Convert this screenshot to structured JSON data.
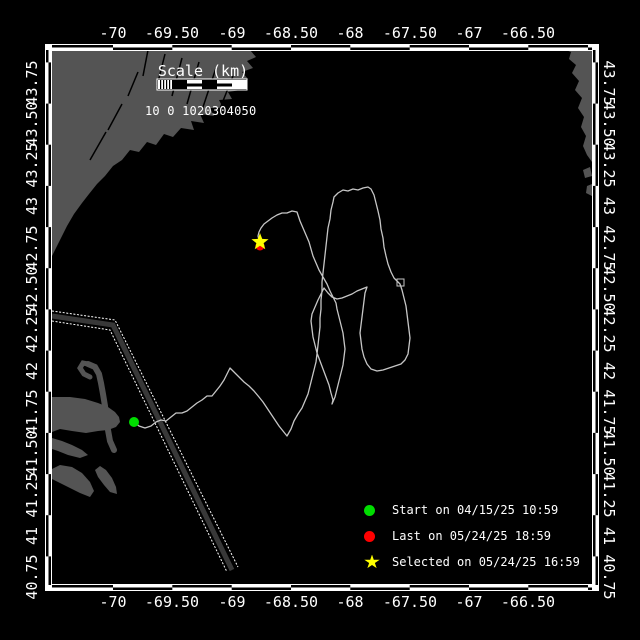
{
  "colors": {
    "background": "#000000",
    "land": "#545454",
    "track": "#c6c6c6",
    "frame": "#ffffff",
    "lane": "#383838",
    "start_green": "#00dd00",
    "last_red": "#ff0000",
    "selected_yellow": "#ffff00"
  },
  "scale_bar": {
    "title": "Scale (km)",
    "numbers": "10 0 1020304050"
  },
  "legend": {
    "items": [
      {
        "marker": "dot",
        "color": "#00dd00",
        "label": "Start on 04/15/25 10:59"
      },
      {
        "marker": "dot",
        "color": "#ff0000",
        "label": "Last on 05/24/25 18:59"
      },
      {
        "marker": "star",
        "color": "#ffff00",
        "label": "Selected on 05/24/25 16:59"
      }
    ],
    "row_tops": [
      501,
      527,
      553
    ]
  },
  "axes": {
    "top": [
      {
        "t": "-70",
        "x": 113
      },
      {
        "t": "-69.50",
        "x": 172
      },
      {
        "t": "-69",
        "x": 232
      },
      {
        "t": "-68.50",
        "x": 291
      },
      {
        "t": "-68",
        "x": 350
      },
      {
        "t": "-67.50",
        "x": 410
      },
      {
        "t": "-67",
        "x": 469
      },
      {
        "t": "-66.50",
        "x": 528
      }
    ],
    "bottom": [
      {
        "t": "-70",
        "x": 113
      },
      {
        "t": "-69.50",
        "x": 172
      },
      {
        "t": "-69",
        "x": 232
      },
      {
        "t": "-68.50",
        "x": 291
      },
      {
        "t": "-68",
        "x": 350
      },
      {
        "t": "-67.50",
        "x": 410
      },
      {
        "t": "-67",
        "x": 469
      },
      {
        "t": "-66.50",
        "x": 528
      }
    ],
    "left": [
      {
        "t": "43.75",
        "y": 83
      },
      {
        "t": "43.50",
        "y": 124
      },
      {
        "t": "43.25",
        "y": 165
      },
      {
        "t": "43",
        "y": 206
      },
      {
        "t": "42.75",
        "y": 248
      },
      {
        "t": "42.50",
        "y": 289
      },
      {
        "t": "42.25",
        "y": 330
      },
      {
        "t": "42",
        "y": 371
      },
      {
        "t": "41.75",
        "y": 412
      },
      {
        "t": "41.50",
        "y": 453
      },
      {
        "t": "41.25",
        "y": 495
      },
      {
        "t": "41",
        "y": 536
      },
      {
        "t": "40.75",
        "y": 577
      }
    ],
    "right": [
      {
        "t": "43.75",
        "y": 83
      },
      {
        "t": "43.50",
        "y": 124
      },
      {
        "t": "43.25",
        "y": 165
      },
      {
        "t": "43",
        "y": 206
      },
      {
        "t": "42.75",
        "y": 248
      },
      {
        "t": "42.50",
        "y": 289
      },
      {
        "t": "42.25",
        "y": 330
      },
      {
        "t": "42",
        "y": 371
      },
      {
        "t": "41.75",
        "y": 412
      },
      {
        "t": "41.50",
        "y": 453
      },
      {
        "t": "41.25",
        "y": 495
      },
      {
        "t": "41",
        "y": 536
      },
      {
        "t": "40.75",
        "y": 577
      }
    ]
  },
  "frame": {
    "x0": 52,
    "x1": 592,
    "y0": 50,
    "y1": 585,
    "lon_bounds": [
      52,
      113,
      172.3,
      231.7,
      291,
      350.3,
      409.7,
      469,
      528.3,
      588,
      592
    ],
    "lat_bounds": [
      50,
      62.4,
      103.6,
      144.7,
      185.9,
      227.1,
      268.2,
      309.4,
      350.6,
      391.7,
      432.9,
      474.1,
      515.2,
      556.4,
      585
    ]
  },
  "markers": {
    "start": {
      "x": 134,
      "y": 422,
      "r": 5
    },
    "last": {
      "x": 260,
      "y": 246,
      "r": 4.5
    },
    "selected": {
      "x": 260,
      "y": 242,
      "scale": 1.0
    }
  },
  "legend_marker_star_scale": 0.85,
  "shapes": {
    "land": [
      {
        "name": "land-maine",
        "points": [
          [
            52,
            50
          ],
          [
            250,
            50
          ],
          [
            256,
            57
          ],
          [
            247,
            61
          ],
          [
            253,
            68
          ],
          [
            242,
            72
          ],
          [
            248,
            79
          ],
          [
            236,
            83
          ],
          [
            241,
            90
          ],
          [
            228,
            92
          ],
          [
            232,
            99
          ],
          [
            219,
            100
          ],
          [
            223,
            108
          ],
          [
            210,
            108
          ],
          [
            214,
            116
          ],
          [
            200,
            114
          ],
          [
            204,
            123
          ],
          [
            191,
            121
          ],
          [
            194,
            130
          ],
          [
            181,
            128
          ],
          [
            173,
            137
          ],
          [
            164,
            134
          ],
          [
            156,
            145
          ],
          [
            147,
            142
          ],
          [
            139,
            152
          ],
          [
            130,
            150
          ],
          [
            122,
            160
          ],
          [
            113,
            166
          ],
          [
            105,
            176
          ],
          [
            97,
            184
          ],
          [
            89,
            194
          ],
          [
            82,
            203
          ],
          [
            74,
            214
          ],
          [
            67,
            226
          ],
          [
            61,
            238
          ],
          [
            56,
            248
          ],
          [
            52,
            256
          ]
        ]
      },
      {
        "name": "land-nova-scotia",
        "points": [
          [
            566,
            50
          ],
          [
            592,
            50
          ],
          [
            592,
            162
          ],
          [
            587,
            155
          ],
          [
            583,
            146
          ],
          [
            586,
            136
          ],
          [
            581,
            127
          ],
          [
            584,
            117
          ],
          [
            578,
            108
          ],
          [
            582,
            98
          ],
          [
            575,
            90
          ],
          [
            579,
            81
          ],
          [
            572,
            73
          ],
          [
            576,
            65
          ],
          [
            569,
            59
          ],
          [
            571,
            52
          ]
        ]
      },
      {
        "name": "land-islet-1",
        "points": [
          [
            583,
            170
          ],
          [
            590,
            167
          ],
          [
            592,
            176
          ],
          [
            585,
            178
          ]
        ]
      },
      {
        "name": "land-islet-2",
        "points": [
          [
            587,
            186
          ],
          [
            592,
            184
          ],
          [
            592,
            196
          ],
          [
            586,
            193
          ]
        ]
      },
      {
        "name": "land-cape-mainland",
        "points": [
          [
            52,
            397
          ],
          [
            70,
            397
          ],
          [
            85,
            399
          ],
          [
            98,
            403
          ],
          [
            108,
            407
          ],
          [
            115,
            412
          ],
          [
            119,
            417
          ],
          [
            120,
            422
          ],
          [
            116,
            427
          ],
          [
            108,
            430
          ],
          [
            98,
            431
          ],
          [
            86,
            433
          ],
          [
            72,
            431
          ],
          [
            60,
            429
          ],
          [
            52,
            432
          ]
        ]
      },
      {
        "name": "land-cape-south",
        "points": [
          [
            52,
            438
          ],
          [
            62,
            441
          ],
          [
            72,
            445
          ],
          [
            82,
            450
          ],
          [
            88,
            455
          ],
          [
            80,
            458
          ],
          [
            68,
            455
          ],
          [
            58,
            451
          ],
          [
            52,
            449
          ]
        ]
      },
      {
        "name": "land-marthas-vineyard",
        "points": [
          [
            50,
            470
          ],
          [
            60,
            465
          ],
          [
            72,
            467
          ],
          [
            82,
            473
          ],
          [
            90,
            482
          ],
          [
            94,
            491
          ],
          [
            90,
            497
          ],
          [
            80,
            493
          ],
          [
            70,
            488
          ],
          [
            60,
            483
          ],
          [
            52,
            479
          ]
        ]
      },
      {
        "name": "land-nantucket",
        "points": [
          [
            95,
            470
          ],
          [
            100,
            466
          ],
          [
            106,
            470
          ],
          [
            112,
            478
          ],
          [
            116,
            487
          ],
          [
            117,
            494
          ],
          [
            110,
            492
          ],
          [
            104,
            485
          ],
          [
            98,
            477
          ]
        ]
      }
    ],
    "land_strokes": [
      {
        "name": "land-cape-arm",
        "width": 6,
        "points": [
          [
            88,
            364
          ],
          [
            95,
            367
          ],
          [
            99,
            374
          ],
          [
            101,
            383
          ],
          [
            103,
            394
          ],
          [
            105,
            406
          ],
          [
            106,
            418
          ],
          [
            108,
            430
          ],
          [
            110,
            441
          ],
          [
            114,
            450
          ]
        ]
      },
      {
        "name": "land-cape-hook",
        "width": 5,
        "points": [
          [
            88,
            364
          ],
          [
            83,
            363
          ],
          [
            80,
            368
          ],
          [
            84,
            374
          ],
          [
            90,
            377
          ]
        ]
      }
    ],
    "rivers": [
      [
        [
          148,
          50
        ],
        [
          143,
          76
        ]
      ],
      [
        [
          165,
          54
        ],
        [
          157,
          86
        ]
      ],
      [
        [
          182,
          58
        ],
        [
          172,
          96
        ]
      ],
      [
        [
          199,
          62
        ],
        [
          187,
          104
        ]
      ],
      [
        [
          216,
          68
        ],
        [
          202,
          110
        ]
      ],
      [
        [
          233,
          76
        ],
        [
          217,
          116
        ]
      ],
      [
        [
          247,
          84
        ],
        [
          230,
          120
        ]
      ],
      [
        [
          128,
          96
        ],
        [
          138,
          72
        ]
      ],
      [
        [
          108,
          130
        ],
        [
          122,
          104
        ]
      ],
      [
        [
          90,
          160
        ],
        [
          106,
          132
        ]
      ]
    ],
    "lane": {
      "center": [
        [
          52,
          316
        ],
        [
          113,
          325
        ],
        [
          232,
          570
        ]
      ],
      "edge1": [
        [
          52,
          311
        ],
        [
          115,
          320
        ],
        [
          238,
          567
        ]
      ],
      "edge2": [
        [
          52,
          321
        ],
        [
          110,
          330
        ],
        [
          227,
          572
        ]
      ]
    },
    "knot": {
      "x": 397,
      "y": 279,
      "w": 7,
      "h": 7
    }
  },
  "track": [
    [
      134,
      422
    ],
    [
      139,
      426
    ],
    [
      145,
      428
    ],
    [
      151,
      426
    ],
    [
      156,
      422
    ],
    [
      161,
      420
    ],
    [
      166,
      421
    ],
    [
      171,
      417
    ],
    [
      176,
      413
    ],
    [
      182,
      413
    ],
    [
      187,
      411
    ],
    [
      192,
      407
    ],
    [
      197,
      403
    ],
    [
      202,
      400
    ],
    [
      207,
      396
    ],
    [
      212,
      396
    ],
    [
      216,
      391
    ],
    [
      220,
      386
    ],
    [
      224,
      380
    ],
    [
      227,
      374
    ],
    [
      230,
      368
    ],
    [
      234,
      372
    ],
    [
      239,
      377
    ],
    [
      244,
      382
    ],
    [
      249,
      386
    ],
    [
      254,
      391
    ],
    [
      259,
      397
    ],
    [
      263,
      402
    ],
    [
      267,
      408
    ],
    [
      271,
      414
    ],
    [
      275,
      420
    ],
    [
      279,
      426
    ],
    [
      283,
      431
    ],
    [
      287,
      436
    ],
    [
      291,
      429
    ],
    [
      294,
      421
    ],
    [
      298,
      414
    ],
    [
      302,
      408
    ],
    [
      305,
      401
    ],
    [
      308,
      394
    ],
    [
      310,
      386
    ],
    [
      312,
      378
    ],
    [
      314,
      370
    ],
    [
      316,
      362
    ],
    [
      317,
      354
    ],
    [
      318,
      345
    ],
    [
      319,
      336
    ],
    [
      320,
      327
    ],
    [
      320,
      318
    ],
    [
      321,
      309
    ],
    [
      321,
      300
    ],
    [
      322,
      291
    ],
    [
      322,
      282
    ],
    [
      323,
      273
    ],
    [
      324,
      264
    ],
    [
      325,
      255
    ],
    [
      326,
      246
    ],
    [
      327,
      237
    ],
    [
      328,
      228
    ],
    [
      330,
      219
    ],
    [
      331,
      210
    ],
    [
      333,
      202
    ],
    [
      334,
      197
    ],
    [
      338,
      193
    ],
    [
      343,
      190
    ],
    [
      348,
      191
    ],
    [
      353,
      189
    ],
    [
      358,
      190
    ],
    [
      363,
      188
    ],
    [
      368,
      187
    ],
    [
      371,
      189
    ],
    [
      374,
      195
    ],
    [
      376,
      203
    ],
    [
      378,
      211
    ],
    [
      380,
      220
    ],
    [
      381,
      229
    ],
    [
      383,
      238
    ],
    [
      384,
      247
    ],
    [
      386,
      256
    ],
    [
      388,
      264
    ],
    [
      391,
      272
    ],
    [
      394,
      278
    ],
    [
      398,
      282
    ],
    [
      400,
      284
    ],
    [
      402,
      290
    ],
    [
      404,
      298
    ],
    [
      406,
      306
    ],
    [
      407,
      314
    ],
    [
      408,
      322
    ],
    [
      409,
      330
    ],
    [
      410,
      338
    ],
    [
      409,
      346
    ],
    [
      408,
      354
    ],
    [
      405,
      360
    ],
    [
      401,
      364
    ],
    [
      395,
      366
    ],
    [
      389,
      368
    ],
    [
      383,
      370
    ],
    [
      377,
      371
    ],
    [
      371,
      369
    ],
    [
      367,
      364
    ],
    [
      364,
      357
    ],
    [
      362,
      349
    ],
    [
      361,
      341
    ],
    [
      360,
      333
    ],
    [
      361,
      325
    ],
    [
      362,
      317
    ],
    [
      363,
      309
    ],
    [
      364,
      301
    ],
    [
      365,
      293
    ],
    [
      367,
      287
    ],
    [
      362,
      289
    ],
    [
      357,
      291
    ],
    [
      352,
      294
    ],
    [
      347,
      296
    ],
    [
      342,
      298
    ],
    [
      337,
      299
    ],
    [
      332,
      297
    ],
    [
      328,
      293
    ],
    [
      324,
      288
    ],
    [
      321,
      294
    ],
    [
      318,
      300
    ],
    [
      315,
      307
    ],
    [
      312,
      314
    ],
    [
      311,
      321
    ],
    [
      312,
      329
    ],
    [
      313,
      337
    ],
    [
      315,
      345
    ],
    [
      317,
      353
    ],
    [
      320,
      361
    ],
    [
      323,
      369
    ],
    [
      326,
      377
    ],
    [
      329,
      385
    ],
    [
      331,
      393
    ],
    [
      333,
      400
    ],
    [
      332,
      404
    ],
    [
      335,
      397
    ],
    [
      337,
      389
    ],
    [
      339,
      381
    ],
    [
      341,
      373
    ],
    [
      343,
      365
    ],
    [
      344,
      357
    ],
    [
      345,
      349
    ],
    [
      344,
      341
    ],
    [
      343,
      333
    ],
    [
      341,
      325
    ],
    [
      339,
      317
    ],
    [
      337,
      309
    ],
    [
      336,
      303
    ],
    [
      333,
      297
    ],
    [
      330,
      291
    ],
    [
      327,
      284
    ],
    [
      323,
      277
    ],
    [
      319,
      270
    ],
    [
      316,
      263
    ],
    [
      313,
      256
    ],
    [
      311,
      249
    ],
    [
      309,
      242
    ],
    [
      306,
      235
    ],
    [
      303,
      228
    ],
    [
      300,
      221
    ],
    [
      298,
      215
    ],
    [
      297,
      212
    ],
    [
      292,
      211
    ],
    [
      287,
      213
    ],
    [
      282,
      213
    ],
    [
      277,
      215
    ],
    [
      272,
      218
    ],
    [
      268,
      221
    ],
    [
      264,
      224
    ],
    [
      261,
      228
    ],
    [
      259,
      232
    ],
    [
      258,
      236
    ],
    [
      259,
      240
    ],
    [
      260,
      242
    ]
  ]
}
